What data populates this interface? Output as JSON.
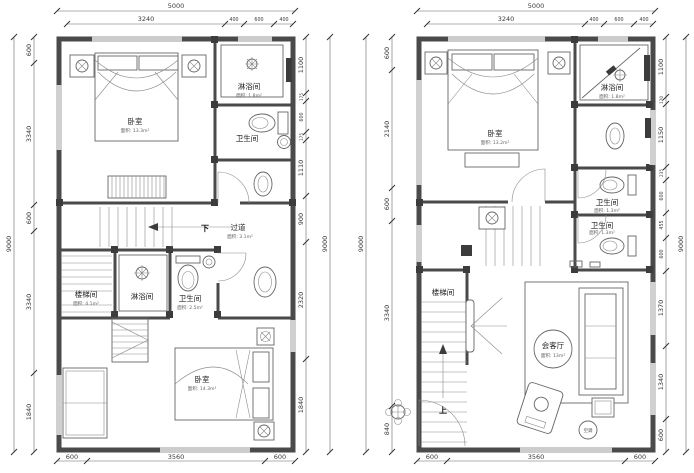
{
  "drawing_title": "两层户型平面图",
  "plans": {
    "left": {
      "dims": {
        "top_total": "5000",
        "top_segments": [
          "3240",
          "400",
          "600",
          "400"
        ],
        "left_total": "9000",
        "left_segments": [
          "600",
          "3340",
          "600",
          "3340",
          "1840"
        ],
        "right_total": "9000",
        "right_segments": [
          "1100",
          "175",
          "600",
          "175",
          "1110",
          "900",
          "2320",
          "1840"
        ],
        "bottom_segments": [
          "600",
          "3560",
          "600"
        ]
      },
      "rooms": {
        "bedroom_top": {
          "name": "卧室",
          "area": "面积: 13.3m²"
        },
        "shower_top": {
          "name": "淋浴间",
          "area": "面积: 1.8m²"
        },
        "bath_top": {
          "name": "卫生间"
        },
        "corridor": {
          "name": "过道",
          "area": "面积: 3.1m²"
        },
        "down_label": "下",
        "stairwell": {
          "name": "楼梯间",
          "area": "面积: 4.1m²"
        },
        "shower_mid": {
          "name": "淋浴间"
        },
        "bath_mid": {
          "name": "卫生间",
          "area": "面积: 2.5m²"
        },
        "bedroom_bottom": {
          "name": "卧室",
          "area": "面积: 14.3m²"
        }
      }
    },
    "right": {
      "dims": {
        "top_total": "5000",
        "top_segments": [
          "3240",
          "400",
          "600",
          "400"
        ],
        "left_total": "9000",
        "left_segments": [
          "600",
          "2140",
          "600",
          "3340",
          "840"
        ],
        "right_total": "9000",
        "right_segments": [
          "1100",
          "120",
          "1150",
          "235",
          "600",
          "455",
          "600",
          "1370",
          "1340",
          "600"
        ],
        "bottom_segments": [
          "600",
          "3560",
          "600"
        ]
      },
      "rooms": {
        "bedroom": {
          "name": "卧室",
          "area": "面积: 13.2m²"
        },
        "shower": {
          "name": "淋浴间",
          "area": "面积: 1.8m²"
        },
        "bath_upper": {
          "name": "卫生间",
          "area": "面积: 1.3m²"
        },
        "bath_lower": {
          "name": "卫生间",
          "area": "面积: 1.3m²"
        },
        "stairwell": {
          "name": "楼梯间"
        },
        "up_label": "上",
        "living": {
          "name": "会客厅",
          "area": "面积: 13m²"
        },
        "ac_label": "空调"
      }
    }
  },
  "colors": {
    "line": "#4a4a4a",
    "dim_text": "#3a3a3a",
    "background": "#ffffff"
  }
}
